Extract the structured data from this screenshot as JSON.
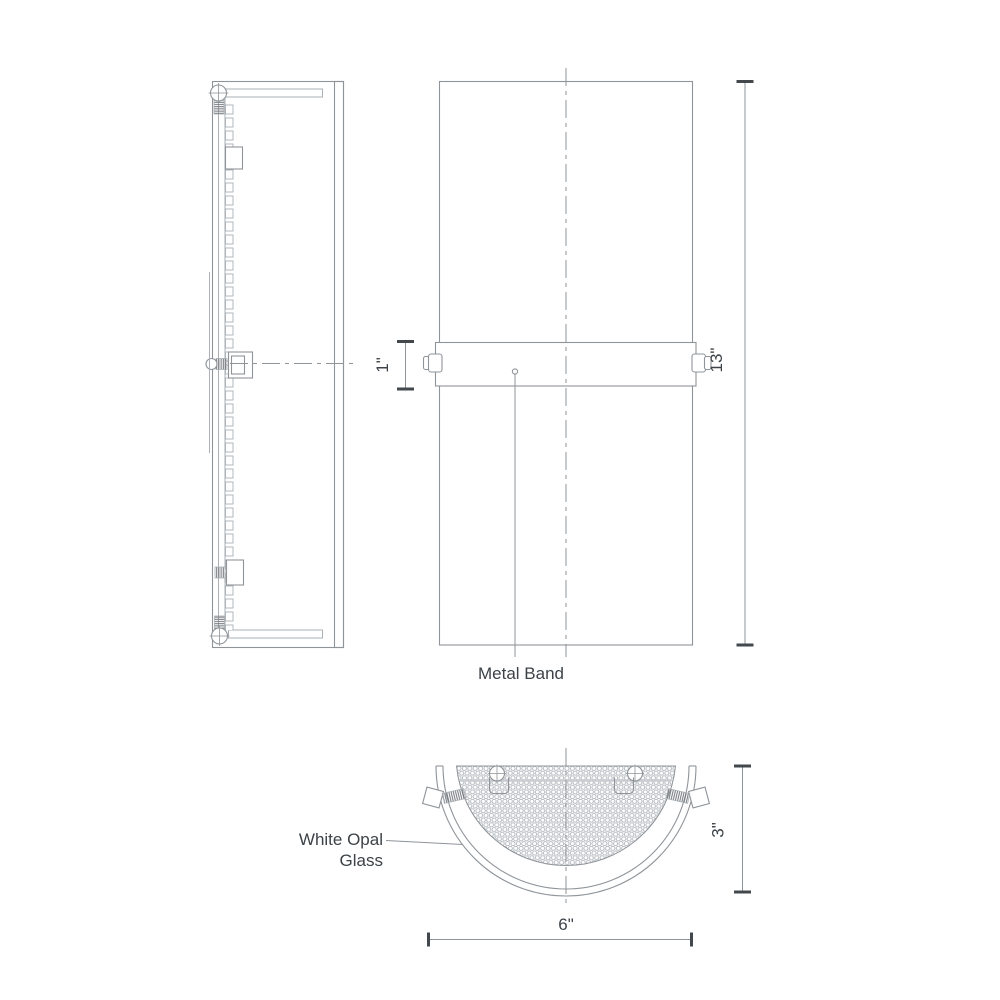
{
  "drawing": {
    "labels": {
      "metal_band": "Metal Band",
      "white_opal_glass_line1": "White Opal",
      "white_opal_glass_line2": "Glass"
    },
    "dimensions": {
      "band_height": "1\"",
      "overall_height": "13\"",
      "projection_depth": "3\"",
      "overall_width": "6\""
    }
  },
  "colors": {
    "line": "#8f9499",
    "line_light": "#aab0b5",
    "tick": "#43484d",
    "text": "#3c4247",
    "mesh": "#aeb4b9",
    "thread": "#6d7277",
    "band_through": "#c9cdd1",
    "background": "#ffffff"
  }
}
